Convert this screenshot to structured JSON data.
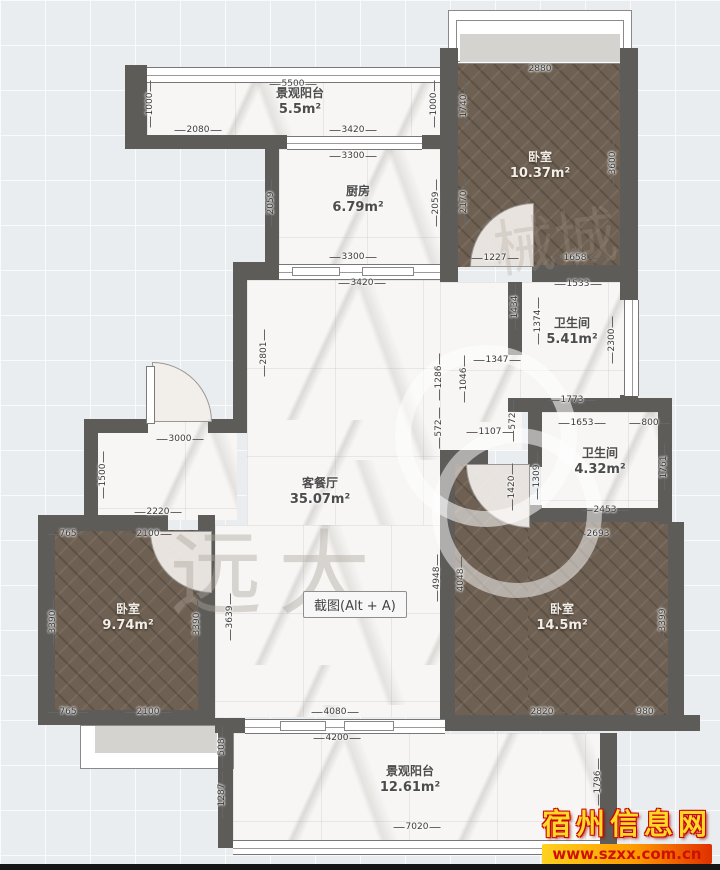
{
  "screenshot_button": {
    "label": "截图(Alt + A)"
  },
  "watermark": {
    "site_name": "宿州信息网",
    "site_url": "www.szxx.com.cn",
    "brand_text": "远大",
    "brand_text2": "械城"
  },
  "colors": {
    "canvas_bg": "#e9edf0",
    "wall": "#5e5c59",
    "wood_floor": "#6e6052",
    "marble_floor": "#f7f6f4",
    "bay_window": "#d4d3d0",
    "watermark_gold": "#ffd829",
    "watermark_red": "#cf1000"
  },
  "rooms": [
    {
      "name": "景观阳台",
      "area": "5.5m²",
      "x": 300,
      "y": 102,
      "tone": "dark"
    },
    {
      "name": "厨房",
      "area": "6.79m²",
      "x": 358,
      "y": 200,
      "tone": "dark"
    },
    {
      "name": "卧室",
      "area": "10.37m²",
      "x": 540,
      "y": 166,
      "tone": "light"
    },
    {
      "name": "卫生间",
      "area": "5.41m²",
      "x": 572,
      "y": 332,
      "tone": "dark"
    },
    {
      "name": "卫生间",
      "area": "4.32m²",
      "x": 600,
      "y": 462,
      "tone": "dark"
    },
    {
      "name": "客餐厅",
      "area": "35.07m²",
      "x": 320,
      "y": 492,
      "tone": "dark"
    },
    {
      "name": "卧室",
      "area": "9.74m²",
      "x": 128,
      "y": 618,
      "tone": "light"
    },
    {
      "name": "卧室",
      "area": "14.5m²",
      "x": 562,
      "y": 618,
      "tone": "light"
    },
    {
      "name": "景观阳台",
      "area": "12.61m²",
      "x": 410,
      "y": 780,
      "tone": "dark"
    }
  ],
  "dims": [
    {
      "t": "5500",
      "x": 293,
      "y": 84
    },
    {
      "t": "1000",
      "x": 150,
      "y": 104,
      "v": 1
    },
    {
      "t": "2080",
      "x": 198,
      "y": 130
    },
    {
      "t": "3420",
      "x": 353,
      "y": 130
    },
    {
      "t": "1000",
      "x": 434,
      "y": 104,
      "v": 1
    },
    {
      "t": "1740",
      "x": 464,
      "y": 106,
      "v": 1
    },
    {
      "t": "3300",
      "x": 353,
      "y": 156
    },
    {
      "t": "2059",
      "x": 271,
      "y": 203,
      "v": 1
    },
    {
      "t": "2059",
      "x": 436,
      "y": 203,
      "v": 1
    },
    {
      "t": "2170",
      "x": 464,
      "y": 202,
      "v": 1
    },
    {
      "t": "3300",
      "x": 353,
      "y": 257
    },
    {
      "t": "2880",
      "x": 540,
      "y": 69
    },
    {
      "t": "3600",
      "x": 613,
      "y": 163,
      "v": 1
    },
    {
      "t": "1227",
      "x": 495,
      "y": 258
    },
    {
      "t": "1658",
      "x": 575,
      "y": 258
    },
    {
      "t": "3420",
      "x": 362,
      "y": 283
    },
    {
      "t": "2801",
      "x": 264,
      "y": 353,
      "v": 1
    },
    {
      "t": "1533",
      "x": 578,
      "y": 284
    },
    {
      "t": "1434",
      "x": 515,
      "y": 307,
      "v": 1
    },
    {
      "t": "1374",
      "x": 538,
      "y": 321,
      "v": 1
    },
    {
      "t": "2300",
      "x": 612,
      "y": 340,
      "v": 1
    },
    {
      "t": "1347",
      "x": 497,
      "y": 360
    },
    {
      "t": "1046",
      "x": 464,
      "y": 379,
      "v": 1
    },
    {
      "t": "1286",
      "x": 439,
      "y": 377,
      "v": 1
    },
    {
      "t": "572",
      "x": 439,
      "y": 428,
      "v": 1
    },
    {
      "t": "572",
      "x": 513,
      "y": 421,
      "v": 1
    },
    {
      "t": "1107",
      "x": 490,
      "y": 432
    },
    {
      "t": "1773",
      "x": 572,
      "y": 400
    },
    {
      "t": "1653",
      "x": 582,
      "y": 423
    },
    {
      "t": "800",
      "x": 650,
      "y": 423
    },
    {
      "t": "1309",
      "x": 537,
      "y": 476,
      "v": 1
    },
    {
      "t": "1761",
      "x": 664,
      "y": 467,
      "v": 1
    },
    {
      "t": "2453",
      "x": 605,
      "y": 510
    },
    {
      "t": "2693",
      "x": 598,
      "y": 534
    },
    {
      "t": "3000",
      "x": 180,
      "y": 439
    },
    {
      "t": "1500",
      "x": 103,
      "y": 475,
      "v": 1
    },
    {
      "t": "2220",
      "x": 158,
      "y": 512
    },
    {
      "t": "765",
      "x": 68,
      "y": 534
    },
    {
      "t": "2100",
      "x": 148,
      "y": 534
    },
    {
      "t": "3390",
      "x": 53,
      "y": 622,
      "v": 1
    },
    {
      "t": "3390",
      "x": 197,
      "y": 624,
      "v": 1
    },
    {
      "t": "3639",
      "x": 230,
      "y": 617,
      "v": 1
    },
    {
      "t": "765",
      "x": 68,
      "y": 712
    },
    {
      "t": "2100",
      "x": 148,
      "y": 712
    },
    {
      "t": "1420",
      "x": 512,
      "y": 487,
      "v": 1
    },
    {
      "t": "4948",
      "x": 437,
      "y": 578,
      "v": 1
    },
    {
      "t": "4048",
      "x": 461,
      "y": 580,
      "v": 1
    },
    {
      "t": "3399",
      "x": 663,
      "y": 620,
      "v": 1
    },
    {
      "t": "2820",
      "x": 542,
      "y": 712
    },
    {
      "t": "980",
      "x": 645,
      "y": 712
    },
    {
      "t": "4080",
      "x": 335,
      "y": 712
    },
    {
      "t": "4200",
      "x": 337,
      "y": 738
    },
    {
      "t": "508",
      "x": 222,
      "y": 747,
      "v": 1
    },
    {
      "t": "1287",
      "x": 222,
      "y": 795,
      "v": 1
    },
    {
      "t": "7020",
      "x": 417,
      "y": 827
    },
    {
      "t": "1796",
      "x": 598,
      "y": 782,
      "v": 1
    }
  ]
}
